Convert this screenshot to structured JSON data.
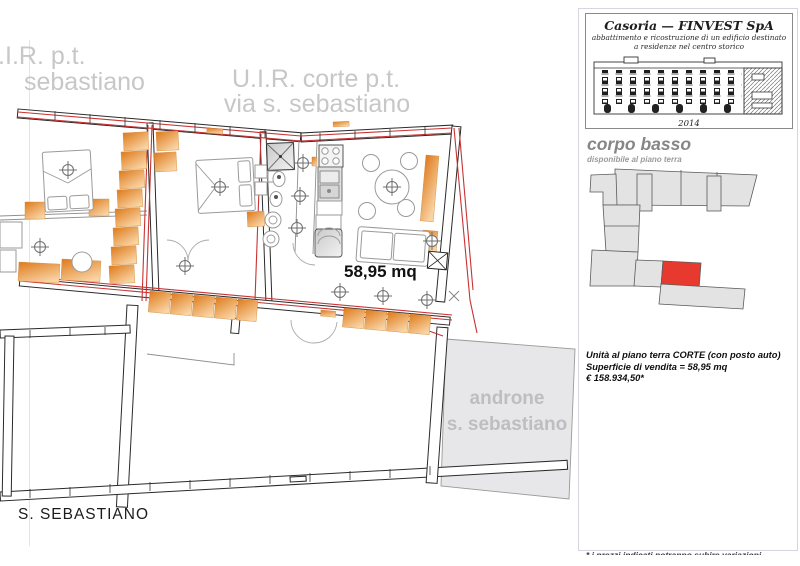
{
  "colors": {
    "orange_dark": "#de7a1c",
    "orange_light": "#f9d4a4",
    "wall_red": "#c83232",
    "unit_red": "#e8392e",
    "block_gray": "#e3e3e3",
    "androne_fill": "#e7e7e9",
    "label_gray": "#c7c7c7",
    "androne_text": "#bdbdc2"
  },
  "plan": {
    "uir_pt_line1": "U.I.R. p.t.",
    "uir_pt_line2": "sebastiano",
    "corte_line1": "U.I.R. corte p.t.",
    "corte_line2": "via s. sebastiano",
    "area": "58,95 mq",
    "androne_line1": "androne",
    "androne_line2": "s. sebastiano",
    "street": "S. SEBASTIANO"
  },
  "sidebar": {
    "title": "Casoria — FINVEST SpA",
    "subtitle1": "abbattimento e ricostruzione di un edificio destinato",
    "subtitle2": "a residenze nel centro storico",
    "year": "2014",
    "heading": "corpo basso",
    "subheading": "disponibile al piano terra",
    "detail1": "Unità al piano terra CORTE (con posto auto)",
    "detail2": "Superficie di vendita = 58,95 mq",
    "price": "€ 158.934,50*",
    "footnote": "* i prezzi indicati potranno subire variazioni"
  }
}
